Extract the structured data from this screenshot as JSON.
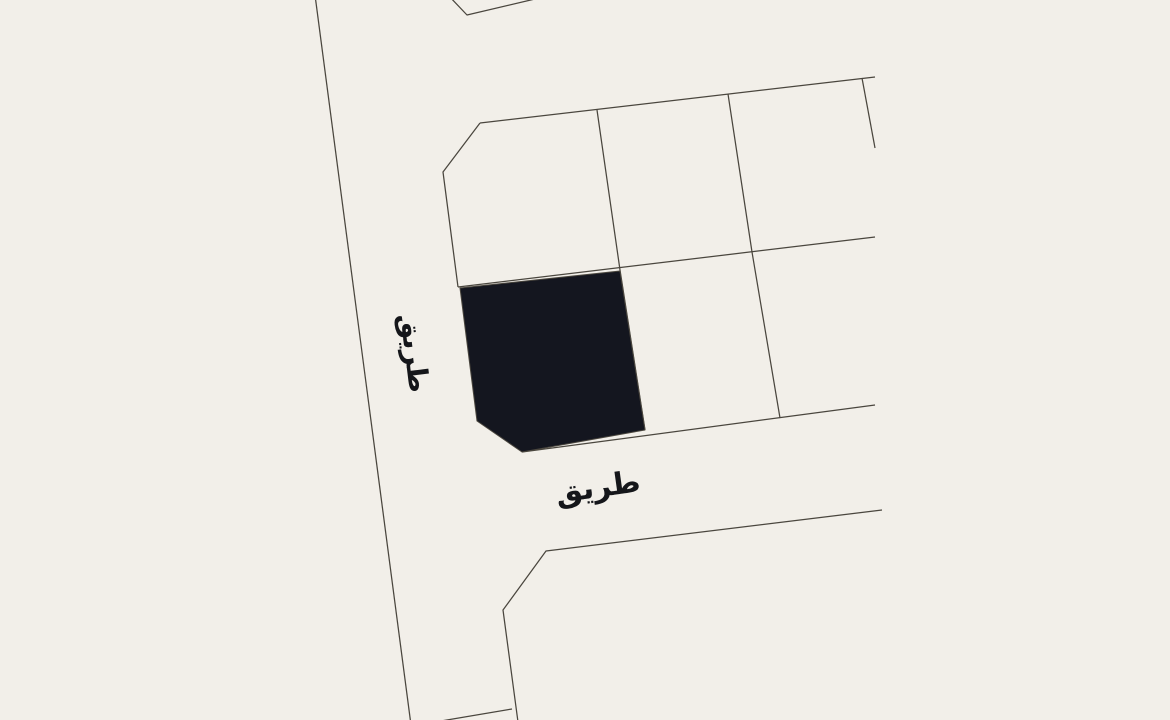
{
  "window": {
    "width": 1170,
    "height": 720
  },
  "map": {
    "type": "cadastral-parcel-map",
    "colors": {
      "background": "#f2efe9",
      "boundary_line": "#4a463e",
      "highlight_fill": "#14161f",
      "label_text": "#15161a"
    },
    "labels": {
      "vertical_road": "طريق",
      "horizontal_road": "طريق"
    },
    "geometry": {
      "west_road_edge": "315,-5 411,725",
      "top_notch": "448,-5 467,15 552,-5",
      "block_north_edge": "480,123 875,77",
      "block_northwest_edge": "480,123 443,172 458,287",
      "block_mid_horizontal": "458,287 875,237",
      "parcel_divider_1": "597,110 620,270 645,430",
      "parcel_divider_2": "728,94 752,252 780,418",
      "parcel_divider_3": "862,78 875,148",
      "south_road_north_edge": "522,452 875,405",
      "lower_block_edge": "518,722 503,610 546,551 882,510",
      "lower_block_divider": "435,722 512,709",
      "highlighted_parcel": "460,288 620,271 645,430 522,452 477,421"
    }
  }
}
